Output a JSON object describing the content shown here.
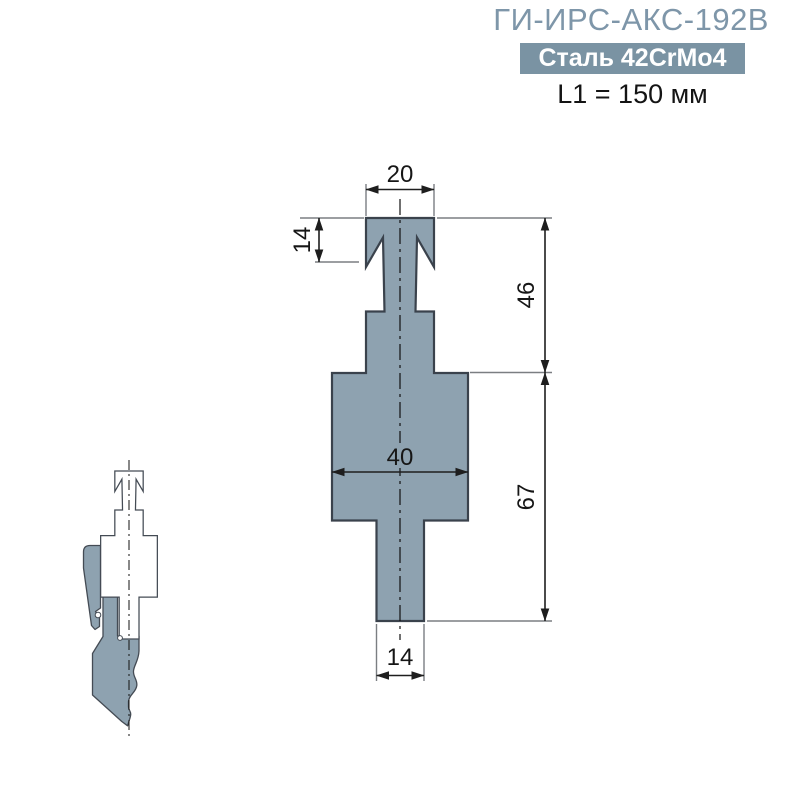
{
  "header": {
    "title": "ГИ-ИРС-АКС-192В",
    "material_badge": "Сталь 42CrMo4",
    "length_label": "L1 = 150 мм"
  },
  "drawing": {
    "dims": {
      "top_width": "20",
      "head_height": "14",
      "upper_height": "46",
      "body_width": "40",
      "lower_height": "67",
      "stem_width": "14"
    }
  },
  "colors": {
    "accent_title": "#7E96A9",
    "badge_background": "#7A93A3",
    "badge_text": "#FFFFFF",
    "shape_fill": "#8EA2B0",
    "shape_outline": "#3A424C"
  }
}
